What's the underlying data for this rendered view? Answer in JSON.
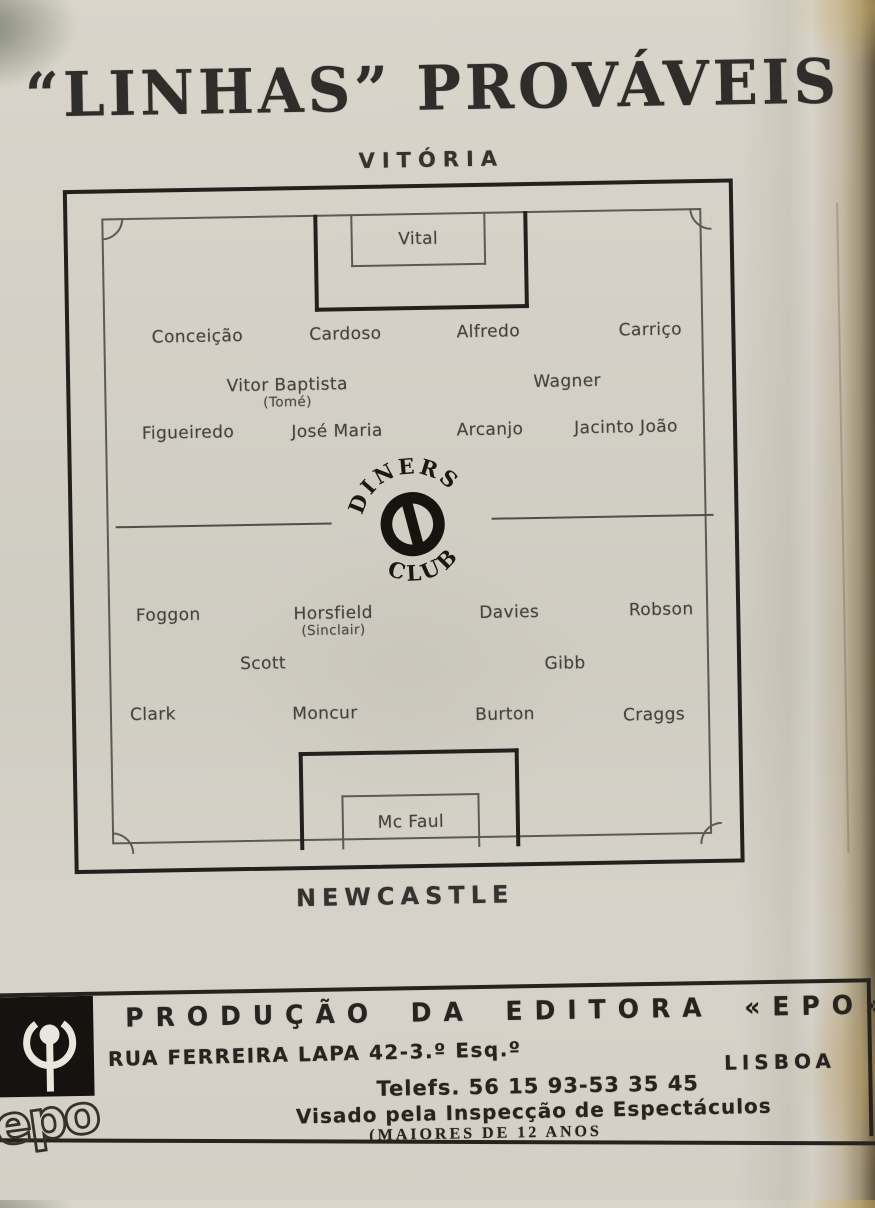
{
  "page": {
    "title": "“LINHAS” PROVÁVEIS"
  },
  "match": {
    "home_team": "VITÓRIA",
    "away_team": "NEWCASTLE",
    "center_logo": {
      "arc_top": "DINERS",
      "arc_bottom": "CLUB"
    },
    "home": {
      "goalkeeper": "Vital",
      "defenders": [
        "Conceição",
        "Cardoso",
        "Alfredo",
        "Carriço"
      ],
      "half_backs": [
        "Vitor Baptista",
        "Wagner"
      ],
      "half_back_alternate": "(Tomé)",
      "forwards": [
        "Figueiredo",
        "José Maria",
        "Arcanjo",
        "Jacinto João"
      ]
    },
    "away": {
      "goalkeeper": "Mc Faul",
      "forwards": [
        "Foggon",
        "Horsfield",
        "Davies",
        "Robson"
      ],
      "forward_alternate": "(Sinclair)",
      "half_backs": [
        "Scott",
        "Gibb"
      ],
      "defenders": [
        "Clark",
        "Moncur",
        "Burton",
        "Craggs"
      ]
    }
  },
  "footer": {
    "production": "PRODUÇÃO DA EDITORA «EPO»",
    "address": "RUA FERREIRA LAPA 42-3.º Esq.º",
    "city": "LISBOA",
    "phones": "Telefs. 56 15 93-53 35 45",
    "approval": "Visado pela Inspecção de Espectáculos",
    "age_rating": "(MAIORES DE 12 ANOS",
    "publisher_logo": "epo"
  },
  "colors": {
    "ink": "#26231f",
    "paper": "#d2cec5",
    "page_edge": "#8a7a55"
  }
}
